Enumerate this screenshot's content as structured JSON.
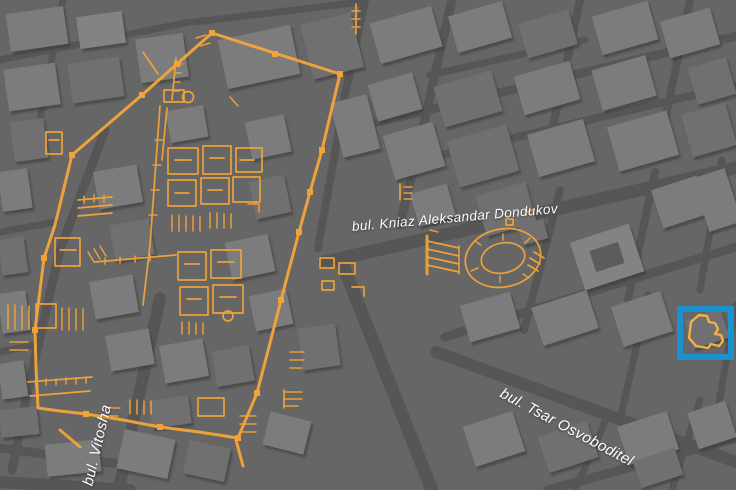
{
  "labels": {
    "streets": [
      {
        "id": "dondukov",
        "text": "bul. Kniaz Aleksandar Dondukov"
      },
      {
        "id": "tsar-osvoboditel",
        "text": "bul. Tsar Osvoboditel"
      },
      {
        "id": "vitosha",
        "text": "bul. Vitosha"
      }
    ]
  },
  "overlay": {
    "name": "ancient-city-plan-overlay",
    "features": [
      "fortress-wall",
      "amphitheatre",
      "forum-buildings",
      "stairs",
      "highlighted-site"
    ]
  },
  "highlight": {
    "name": "selection-box",
    "shape": "rectangle"
  },
  "colors": {
    "ground": "#666666",
    "street": "#565656",
    "bldg": "#7b7b7b",
    "overlay-orange": "#F2A438",
    "highlight-blue": "#1B92CE",
    "label": "#ffffff"
  }
}
